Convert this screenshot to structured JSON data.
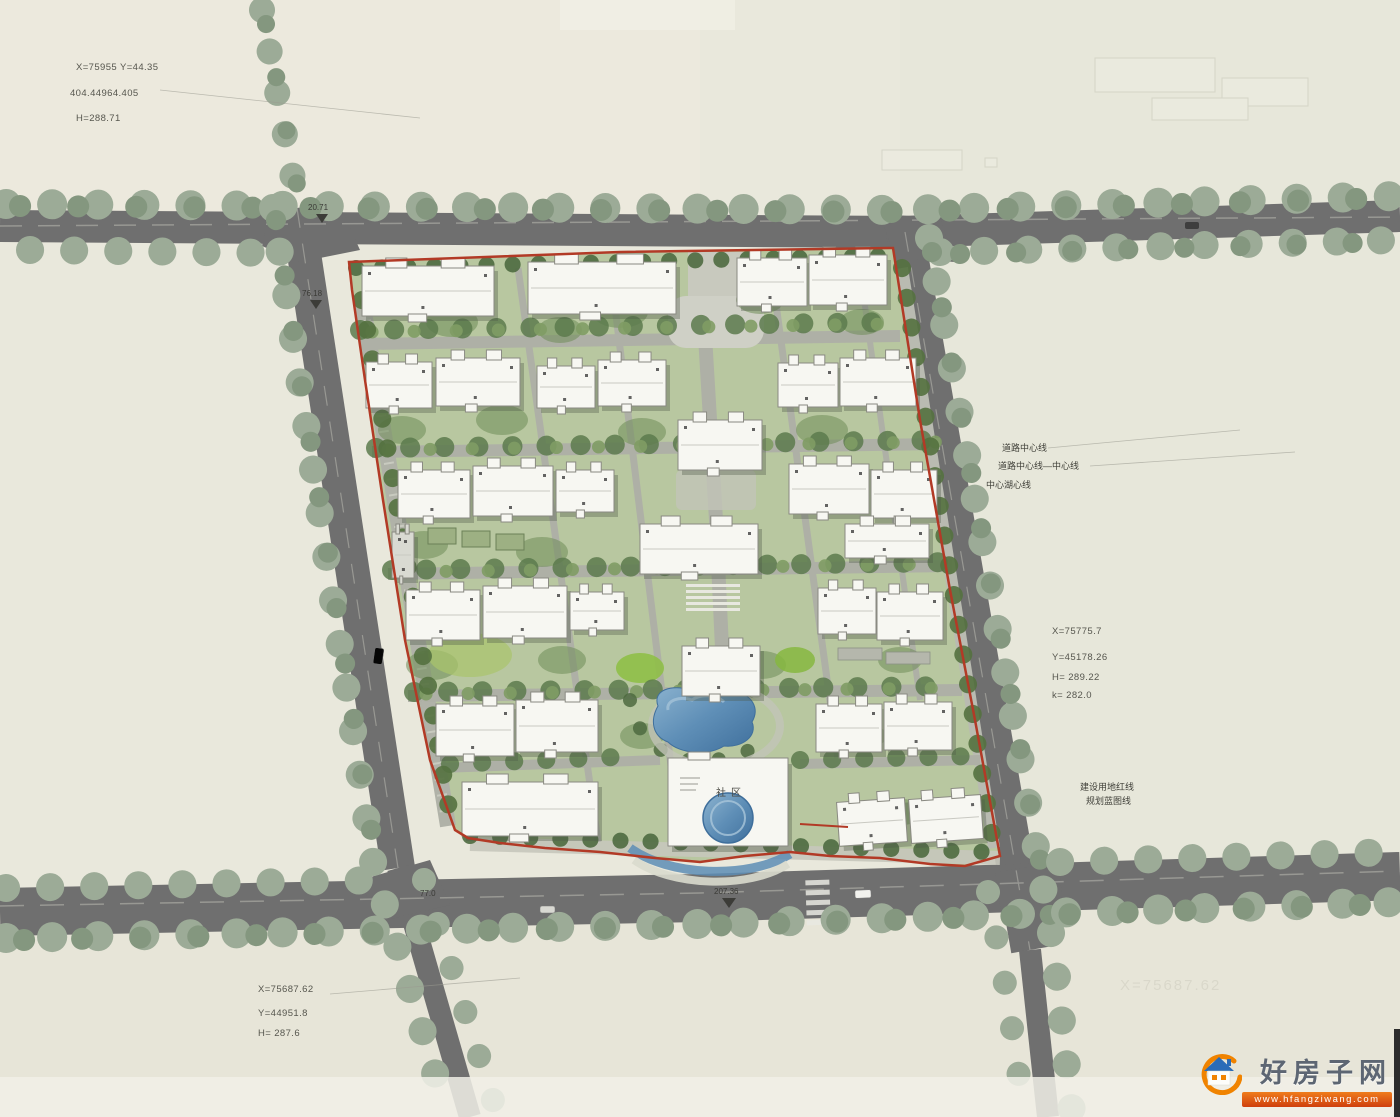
{
  "plan": {
    "title": "residential-community-site-plan",
    "surveys": {
      "top_left": {
        "lines": [
          "X=75955 Y=44.35",
          "404.44964.405",
          "H=288.71"
        ]
      },
      "right": {
        "lines": [
          "X=75775.7",
          "Y=45178.26",
          "H=  289.22",
          "k=  282.0"
        ]
      },
      "bottom_left": {
        "lines": [
          "X=75687.62",
          "Y=44951.8",
          "H= 287.6"
        ]
      },
      "ghost_text": "X=75687.62"
    },
    "road_labels": {
      "centerline_1": "道路中心线",
      "centerline_2": "道路中心线—中心线",
      "centerline_3": "中心湖心线",
      "redline_1": "建设用地红线",
      "redline_2": "规划蓝图线"
    },
    "dimensions": [
      {
        "text": "20.71"
      },
      {
        "text": "76.18"
      },
      {
        "text": "77.0"
      },
      {
        "text": "207.36"
      }
    ],
    "club_label": "社区",
    "colors": {
      "road": "#6f6f6f",
      "site_green": "#b8c7a0",
      "tree_sage": "#9cab97",
      "tree_dark": "#5c7a4c",
      "red_line": "#b23a26",
      "pond_blue": "#5f8fb7",
      "building_white": "#f7f7f2"
    },
    "buildings": [
      {
        "x": 362,
        "y": 266,
        "w": 132,
        "h": 50,
        "r": 0
      },
      {
        "x": 528,
        "y": 262,
        "w": 148,
        "h": 52,
        "r": 0
      },
      {
        "x": 737,
        "y": 258,
        "w": 70,
        "h": 48,
        "r": 0
      },
      {
        "x": 809,
        "y": 255,
        "w": 78,
        "h": 50,
        "r": 0
      },
      {
        "x": 366,
        "y": 362,
        "w": 66,
        "h": 46,
        "r": 0
      },
      {
        "x": 436,
        "y": 358,
        "w": 84,
        "h": 48,
        "r": 0
      },
      {
        "x": 537,
        "y": 366,
        "w": 58,
        "h": 42,
        "r": 0
      },
      {
        "x": 598,
        "y": 360,
        "w": 68,
        "h": 46,
        "r": 0
      },
      {
        "x": 778,
        "y": 363,
        "w": 60,
        "h": 44,
        "r": 0
      },
      {
        "x": 840,
        "y": 358,
        "w": 76,
        "h": 48,
        "r": 0
      },
      {
        "x": 678,
        "y": 420,
        "w": 84,
        "h": 50,
        "r": 0
      },
      {
        "x": 789,
        "y": 464,
        "w": 80,
        "h": 50,
        "r": 0
      },
      {
        "x": 871,
        "y": 470,
        "w": 66,
        "h": 48,
        "r": 0
      },
      {
        "x": 398,
        "y": 470,
        "w": 72,
        "h": 48,
        "r": 0
      },
      {
        "x": 473,
        "y": 466,
        "w": 80,
        "h": 50,
        "r": 0
      },
      {
        "x": 556,
        "y": 470,
        "w": 58,
        "h": 42,
        "r": 0
      },
      {
        "x": 640,
        "y": 524,
        "w": 118,
        "h": 50,
        "r": 0
      },
      {
        "x": 845,
        "y": 524,
        "w": 84,
        "h": 34,
        "r": 0
      },
      {
        "x": 406,
        "y": 590,
        "w": 74,
        "h": 50,
        "r": 0
      },
      {
        "x": 483,
        "y": 586,
        "w": 84,
        "h": 52,
        "r": 0
      },
      {
        "x": 570,
        "y": 592,
        "w": 54,
        "h": 38,
        "r": 0
      },
      {
        "x": 818,
        "y": 588,
        "w": 58,
        "h": 46,
        "r": 0
      },
      {
        "x": 877,
        "y": 592,
        "w": 66,
        "h": 48,
        "r": 0
      },
      {
        "x": 682,
        "y": 646,
        "w": 78,
        "h": 50,
        "r": 0
      },
      {
        "x": 436,
        "y": 704,
        "w": 78,
        "h": 52,
        "r": 0
      },
      {
        "x": 516,
        "y": 700,
        "w": 82,
        "h": 52,
        "r": 0
      },
      {
        "x": 816,
        "y": 704,
        "w": 66,
        "h": 48,
        "r": 0
      },
      {
        "x": 884,
        "y": 702,
        "w": 68,
        "h": 48,
        "r": 0
      },
      {
        "x": 462,
        "y": 782,
        "w": 136,
        "h": 54,
        "r": 0
      },
      {
        "x": 838,
        "y": 800,
        "w": 68,
        "h": 44,
        "r": -4
      },
      {
        "x": 910,
        "y": 797,
        "w": 72,
        "h": 44,
        "r": -4
      },
      {
        "x": 392,
        "y": 532,
        "w": 22,
        "h": 46,
        "r": 0,
        "dark": true
      }
    ]
  },
  "watermark": {
    "site_name": "好房子网",
    "url": "www.hfangziwang.com"
  }
}
